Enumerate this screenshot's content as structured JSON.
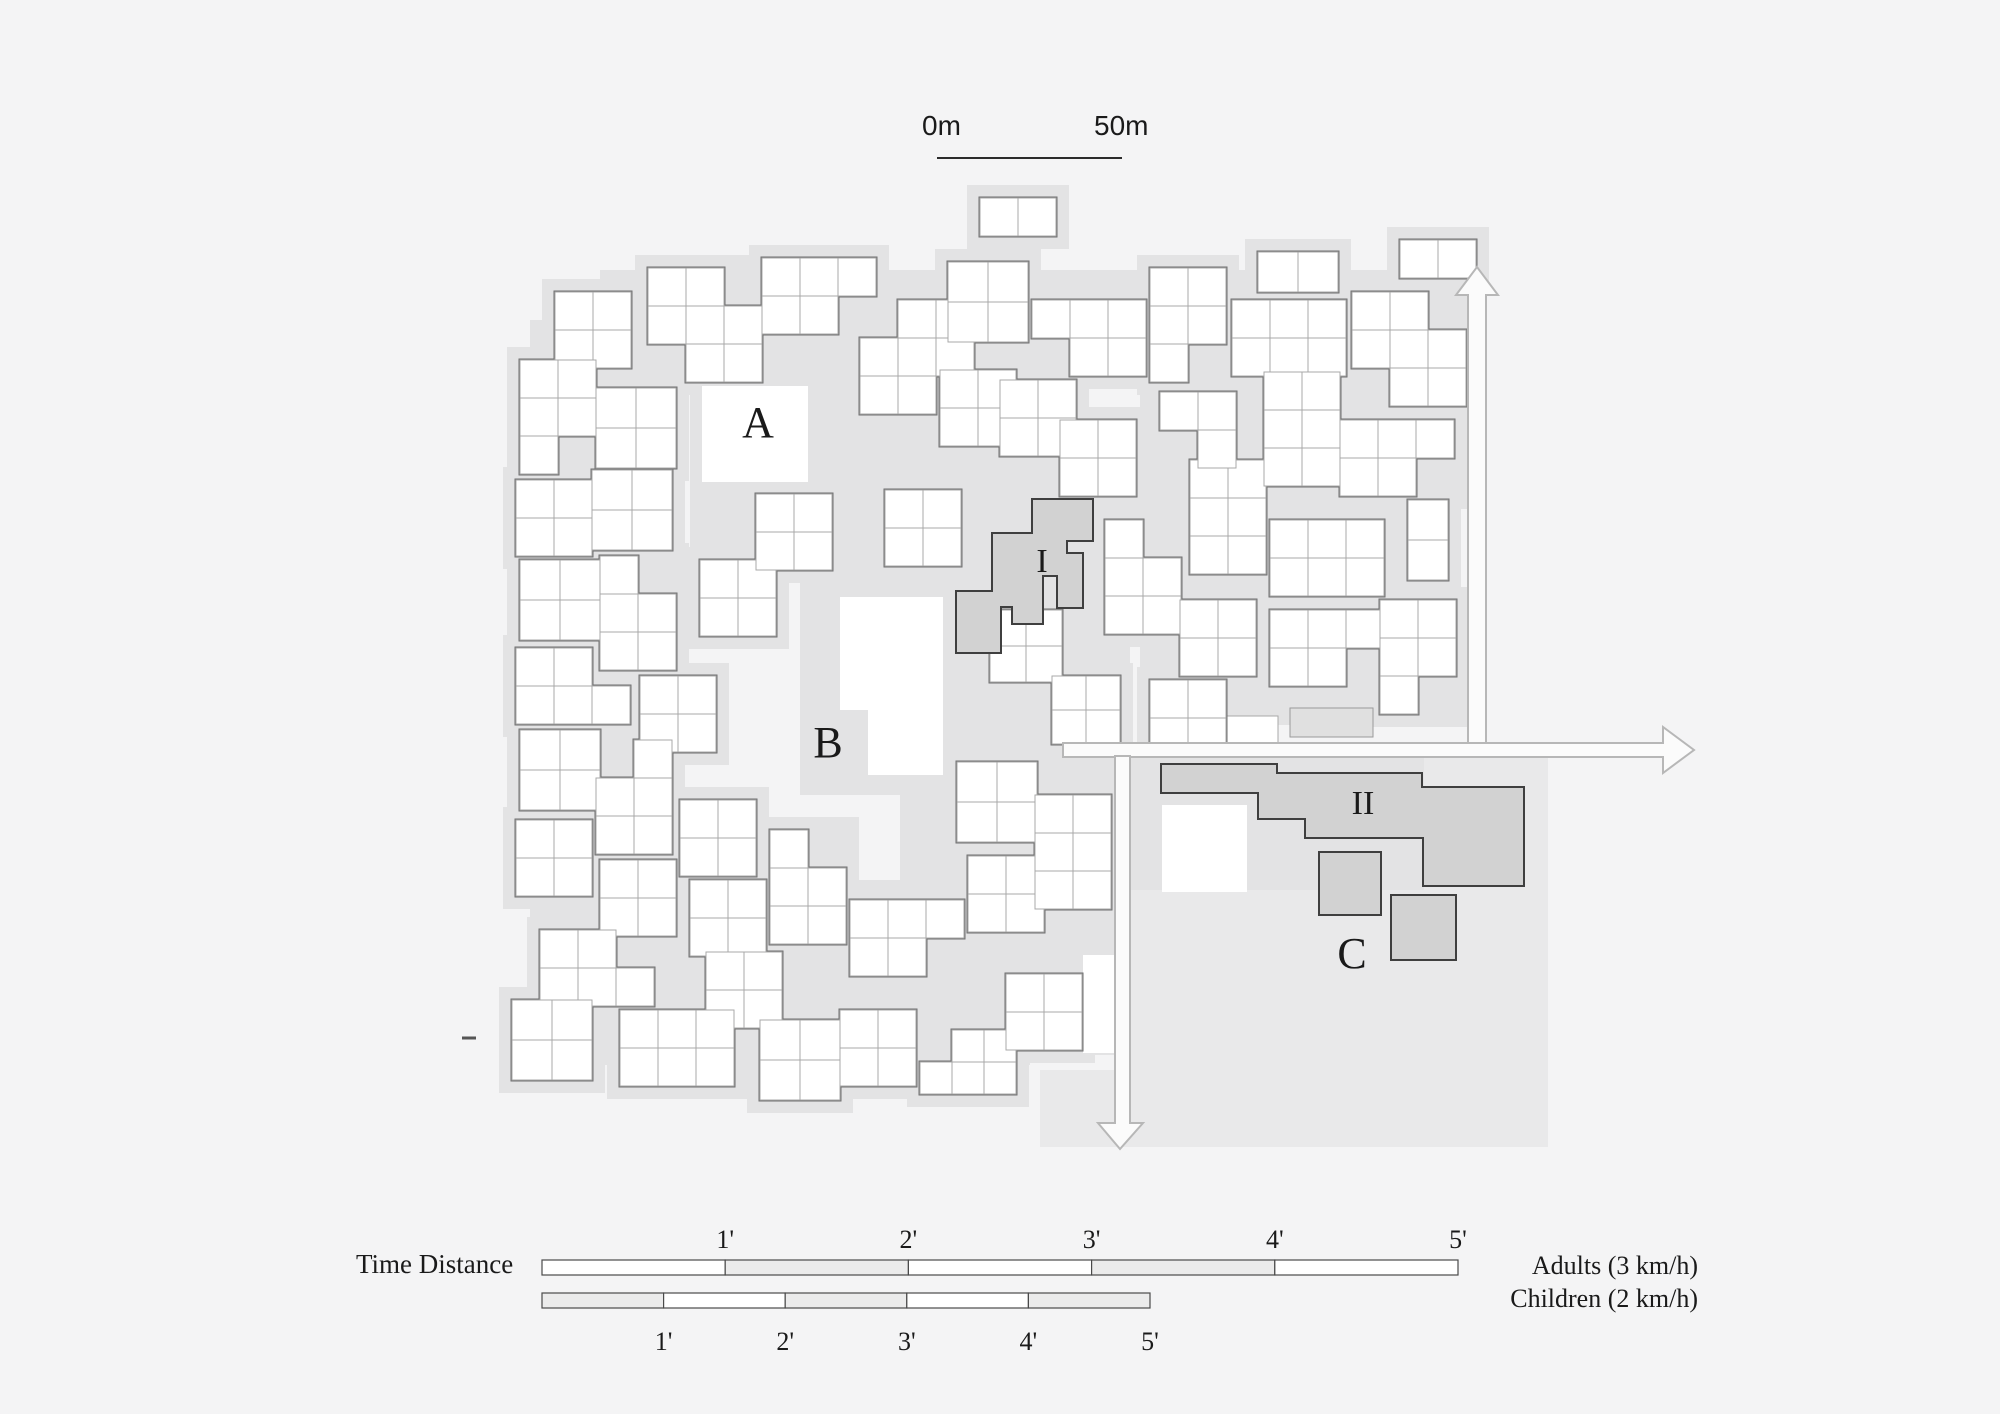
{
  "figure": {
    "type": "architectural site plan with walking time-distance legend",
    "width": 2000,
    "height": 1414
  },
  "colors": {
    "page_bg": "#f4f4f5",
    "ground": "#e3e3e4",
    "c_area": "#e9e9ea",
    "building_fill": "#ffffff",
    "cell_stroke": "#a9a9a9",
    "cluster_outline": "#6f6f6f",
    "special_fill": "#d2d2d2",
    "special_stroke": "#3f3f3f",
    "slab_fill": "#e0e0e0",
    "slab_stroke": "#9a9a9a",
    "arrow_fill": "#fbfbfb",
    "arrow_stroke": "#b7b7b7",
    "scale_line": "#2b2b2b",
    "legend_stroke": "#4a4a4a",
    "legend_gray": "#ebebeb",
    "text": "#1a1a1a"
  },
  "scalebar": {
    "label_start": "0m",
    "label_end": "50m",
    "line": {
      "x1": 937,
      "y1": 158,
      "x2": 1122,
      "y2": 158
    }
  },
  "plan_labels": [
    {
      "id": "A",
      "text": "A",
      "x": 758,
      "y": 437,
      "size": 44
    },
    {
      "id": "B",
      "text": "B",
      "x": 828,
      "y": 757,
      "size": 44
    },
    {
      "id": "C",
      "text": "C",
      "x": 1352,
      "y": 968,
      "size": 44
    },
    {
      "id": "I",
      "text": "I",
      "x": 1042,
      "y": 572,
      "size": 34
    },
    {
      "id": "II",
      "text": "II",
      "x": 1363,
      "y": 814,
      "size": 34
    }
  ],
  "legend": {
    "title": "Time Distance",
    "bars": [
      {
        "id": "adults",
        "name": "Adults (3 km/h)",
        "x": 542,
        "y": 1260,
        "w": 916,
        "h": 15,
        "tick_labels": [
          "1'",
          "2'",
          "3'",
          "4'",
          "5'"
        ],
        "label_side": "top",
        "label_y": 1248,
        "segment_fills": [
          "#ffffff",
          "#ebebeb",
          "#ffffff",
          "#ebebeb",
          "#ffffff"
        ]
      },
      {
        "id": "children",
        "name": "Children (2 km/h)",
        "x": 542,
        "y": 1293,
        "w": 608,
        "h": 15,
        "tick_labels": [
          "1'",
          "2'",
          "3'",
          "4'",
          "5'"
        ],
        "label_side": "bottom",
        "label_y": 1350,
        "segment_fills": [
          "#ebebeb",
          "#ffffff",
          "#ebebeb",
          "#ffffff",
          "#ebebeb"
        ]
      }
    ],
    "tick_font_size": 26
  },
  "plan": {
    "ground_patches": [
      [
        935,
        455,
        195,
        245
      ],
      [
        800,
        540,
        215,
        255
      ],
      [
        690,
        350,
        270,
        215
      ],
      [
        545,
        430,
        100,
        430
      ],
      [
        560,
        880,
        470,
        185
      ],
      [
        1140,
        330,
        310,
        395
      ],
      [
        900,
        700,
        215,
        355
      ],
      [
        600,
        270,
        810,
        110
      ],
      [
        1128,
        756,
        296,
        134
      ],
      [
        530,
        320,
        80,
        700
      ]
    ],
    "c_area_patches": [
      [
        1128,
        890,
        420,
        257
      ],
      [
        1424,
        756,
        124,
        140
      ],
      [
        1040,
        1070,
        110,
        77
      ]
    ],
    "clusters": [
      [
        555,
        292,
        2,
        2,
        38,
        []
      ],
      [
        520,
        360,
        2,
        3,
        38,
        [
          [
            1,
            2
          ]
        ]
      ],
      [
        648,
        268,
        3,
        3,
        38,
        [
          [
            0,
            2
          ],
          [
            2,
            0
          ]
        ]
      ],
      [
        596,
        388,
        2,
        2,
        40,
        []
      ],
      [
        762,
        258,
        3,
        2,
        38,
        [
          [
            2,
            1
          ]
        ]
      ],
      [
        860,
        300,
        3,
        3,
        38,
        [
          [
            0,
            0
          ],
          [
            2,
            2
          ]
        ]
      ],
      [
        948,
        262,
        2,
        2,
        40,
        []
      ],
      [
        1032,
        300,
        3,
        2,
        38,
        [
          [
            0,
            1
          ]
        ]
      ],
      [
        1150,
        268,
        2,
        3,
        38,
        [
          [
            1,
            2
          ]
        ]
      ],
      [
        1232,
        300,
        3,
        2,
        38,
        []
      ],
      [
        1258,
        252,
        2,
        1,
        40,
        []
      ],
      [
        1352,
        292,
        3,
        3,
        38,
        [
          [
            2,
            0
          ],
          [
            0,
            2
          ]
        ]
      ],
      [
        980,
        198,
        2,
        1,
        38,
        []
      ],
      [
        1400,
        240,
        2,
        1,
        38,
        []
      ],
      [
        516,
        480,
        2,
        2,
        38,
        []
      ],
      [
        592,
        470,
        2,
        2,
        40,
        []
      ],
      [
        940,
        370,
        2,
        2,
        38,
        []
      ],
      [
        1000,
        380,
        2,
        2,
        38,
        []
      ],
      [
        1060,
        420,
        2,
        2,
        38,
        []
      ],
      [
        1190,
        460,
        2,
        3,
        38,
        []
      ],
      [
        1264,
        372,
        2,
        3,
        38,
        []
      ],
      [
        1340,
        420,
        3,
        2,
        38,
        [
          [
            2,
            1
          ]
        ]
      ],
      [
        1408,
        500,
        1,
        2,
        40,
        []
      ],
      [
        1160,
        392,
        2,
        2,
        38,
        [
          [
            0,
            1
          ]
        ]
      ],
      [
        520,
        560,
        2,
        2,
        40,
        []
      ],
      [
        600,
        556,
        2,
        3,
        38,
        [
          [
            1,
            0
          ]
        ]
      ],
      [
        516,
        648,
        3,
        2,
        38,
        [
          [
            2,
            0
          ]
        ]
      ],
      [
        640,
        676,
        2,
        2,
        38,
        []
      ],
      [
        700,
        560,
        2,
        2,
        38,
        []
      ],
      [
        756,
        494,
        2,
        2,
        38,
        []
      ],
      [
        885,
        490,
        2,
        2,
        38,
        []
      ],
      [
        1105,
        520,
        2,
        3,
        38,
        [
          [
            1,
            0
          ]
        ]
      ],
      [
        1270,
        520,
        3,
        2,
        38,
        []
      ],
      [
        1180,
        600,
        2,
        2,
        38,
        []
      ],
      [
        1270,
        610,
        3,
        2,
        38,
        [
          [
            2,
            1
          ]
        ]
      ],
      [
        1380,
        600,
        2,
        3,
        38,
        [
          [
            1,
            2
          ]
        ]
      ],
      [
        1150,
        680,
        2,
        2,
        38,
        []
      ],
      [
        990,
        610,
        2,
        2,
        36,
        []
      ],
      [
        1052,
        676,
        2,
        2,
        34,
        []
      ],
      [
        520,
        730,
        2,
        2,
        40,
        []
      ],
      [
        596,
        740,
        2,
        3,
        38,
        [
          [
            0,
            0
          ]
        ]
      ],
      [
        516,
        820,
        2,
        2,
        38,
        []
      ],
      [
        600,
        860,
        2,
        2,
        38,
        []
      ],
      [
        540,
        930,
        3,
        2,
        38,
        [
          [
            2,
            0
          ]
        ]
      ],
      [
        512,
        1000,
        2,
        2,
        40,
        []
      ],
      [
        680,
        800,
        2,
        2,
        38,
        []
      ],
      [
        690,
        880,
        2,
        2,
        38,
        []
      ],
      [
        706,
        952,
        2,
        2,
        38,
        []
      ],
      [
        620,
        1010,
        3,
        2,
        38,
        []
      ],
      [
        760,
        1020,
        2,
        2,
        40,
        []
      ],
      [
        840,
        1010,
        2,
        2,
        38,
        []
      ],
      [
        770,
        830,
        2,
        3,
        38,
        [
          [
            1,
            0
          ]
        ]
      ],
      [
        850,
        900,
        3,
        2,
        38,
        [
          [
            2,
            1
          ]
        ]
      ],
      [
        968,
        856,
        2,
        2,
        38,
        []
      ],
      [
        920,
        1030,
        3,
        2,
        32,
        [
          [
            0,
            0
          ]
        ]
      ],
      [
        1006,
        974,
        2,
        2,
        38,
        []
      ],
      [
        957,
        762,
        2,
        2,
        40,
        []
      ],
      [
        1035,
        795,
        2,
        3,
        38,
        []
      ]
    ],
    "plazas": [
      {
        "type": "path",
        "d": "M840,597 H943 V775 H868 V710 H840 Z"
      },
      {
        "type": "rect",
        "x": 702,
        "y": 386,
        "w": 106,
        "h": 96
      },
      {
        "type": "rect",
        "x": 1162,
        "y": 805,
        "w": 85,
        "h": 87
      },
      {
        "type": "rect",
        "x": 1192,
        "y": 716,
        "w": 86,
        "h": 27,
        "stroke": true
      },
      {
        "type": "rect",
        "x": 1083,
        "y": 955,
        "w": 32,
        "h": 98
      }
    ],
    "slab": {
      "x": 1290,
      "y": 708,
      "w": 83,
      "h": 29
    },
    "special_buildings": [
      {
        "id": "I",
        "d": "M1032,499 H1093 V541 H1067 V553 H1083 V608 H1057 V576 H1043 V624 H1012 V607 H1001 V653 H956 V591 H992 V533 H1032 Z"
      },
      {
        "id": "II",
        "d": "M1161,764 H1277 V773 H1422 V787 H1524 V886 H1423 V838 H1305 V819 H1258 V793 H1161 Z"
      },
      {
        "id": "C-square-1",
        "rect": [
          1319,
          852,
          62,
          63
        ]
      },
      {
        "id": "C-square-2",
        "rect": [
          1391,
          895,
          65,
          65
        ]
      }
    ],
    "arrows": [
      {
        "id": "arrow-up",
        "d": "M1468,744 V295 H1456 L1477,267 L1498,295 H1486 V744 Z"
      },
      {
        "id": "arrow-right",
        "d": "M1063,743 H1663 V727 L1694,750 L1663,773 V757 H1063 Z"
      },
      {
        "id": "arrow-down",
        "d": "M1115,756 V1123 H1098 L1120,1149 L1143,1123 H1130 V756 Z"
      }
    ],
    "tick_dash": {
      "x1": 462,
      "y1": 1038,
      "x2": 476,
      "y2": 1038
    }
  }
}
